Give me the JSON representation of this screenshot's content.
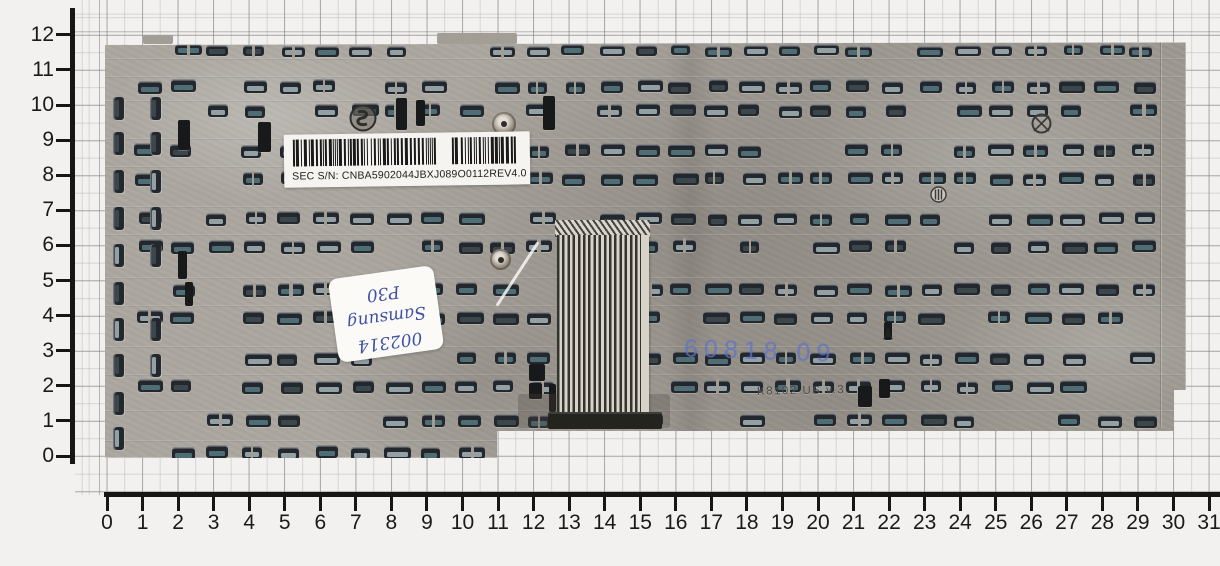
{
  "rulers": {
    "left": {
      "labels": [
        "0",
        "1",
        "2",
        "3",
        "4",
        "5",
        "6",
        "7",
        "8",
        "9",
        "10",
        "11",
        "12"
      ]
    },
    "bottom": {
      "labels": [
        "0",
        "1",
        "2",
        "3",
        "4",
        "5",
        "6",
        "7",
        "8",
        "9",
        "10",
        "11",
        "12",
        "13",
        "14",
        "15",
        "16",
        "17",
        "18",
        "19",
        "20",
        "21",
        "22",
        "23",
        "24",
        "25",
        "26",
        "27",
        "28",
        "29",
        "30",
        "31"
      ]
    }
  },
  "barcode_label": {
    "serial": "SEC S/N: CNBA5902044JBXJ089O0112",
    "revision": "REV4.0"
  },
  "handwritten_sticker": {
    "lines": [
      "002314",
      "Samsung",
      "P30"
    ]
  },
  "plate_markings": {
    "blue_stamp": "60818 09",
    "etched_stamp": "K8102 US v.3"
  },
  "colors": {
    "background": "#f2f1ef",
    "ruler": "#161616",
    "plate": "#a5a199",
    "clip_dark": "#22282d",
    "clip_slot_teal": "#4f6d74",
    "clip_slot_gray": "#94a1a4",
    "clip_slot_dark": "#3c474c",
    "label_bg": "#f5f4f1",
    "ink_blue": "#3f51a5",
    "stamp_blue": "rgba(96,114,200,0.62)"
  }
}
